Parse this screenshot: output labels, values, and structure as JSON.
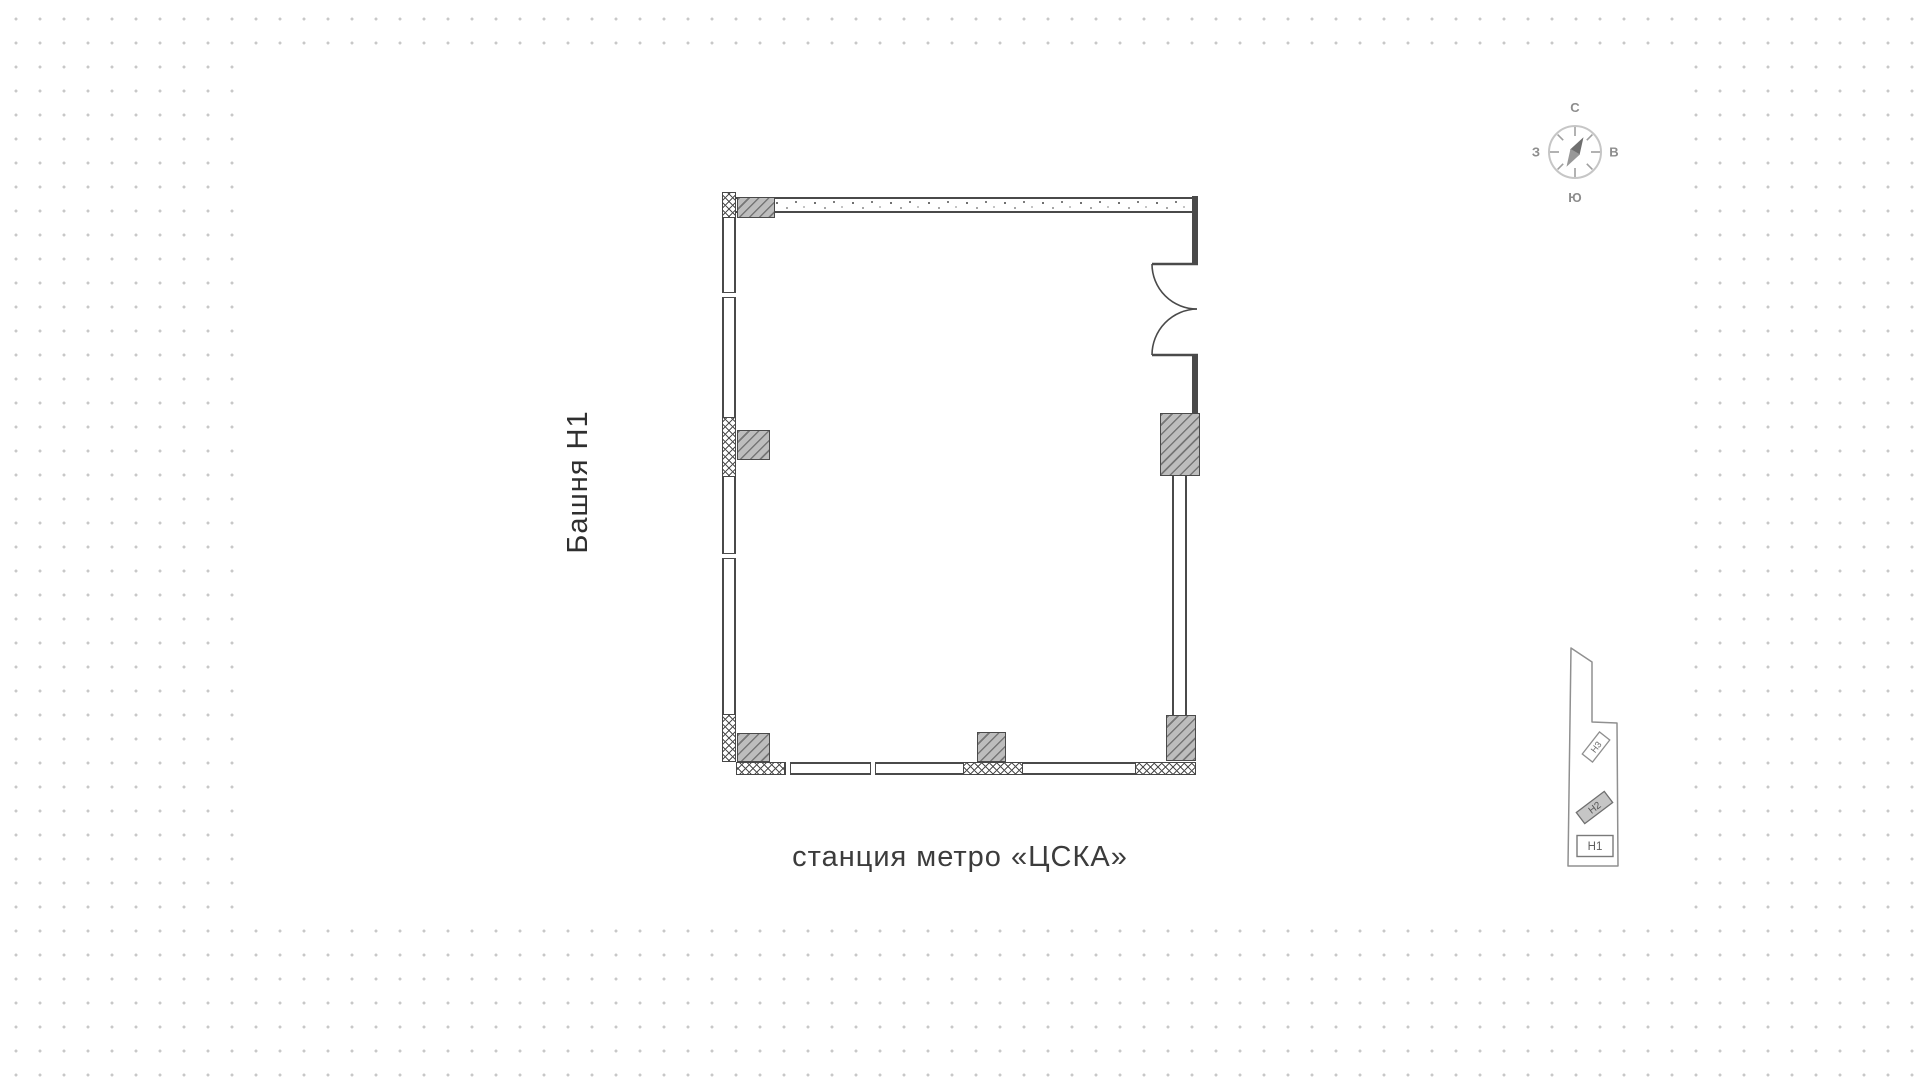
{
  "labels": {
    "tower": "Башня Н1",
    "metro": "станция метро «ЦСКА»"
  },
  "compass": {
    "north": "С",
    "south": "Ю",
    "west": "З",
    "east": "В"
  },
  "minimap": {
    "towers": [
      {
        "label": "Н3",
        "state": "normal"
      },
      {
        "label": "Н2",
        "state": "highlighted"
      },
      {
        "label": "Н1",
        "state": "normal"
      }
    ]
  },
  "colors": {
    "wall_line": "#4a4a4a",
    "column_fill": "#bdbdbd",
    "background_dot": "#c8c8c8",
    "text": "#3c3c3c",
    "compass_gray": "#8d8d8d",
    "minimap_outline": "#909090",
    "minimap_highlight_fill": "#c6c6c6"
  }
}
